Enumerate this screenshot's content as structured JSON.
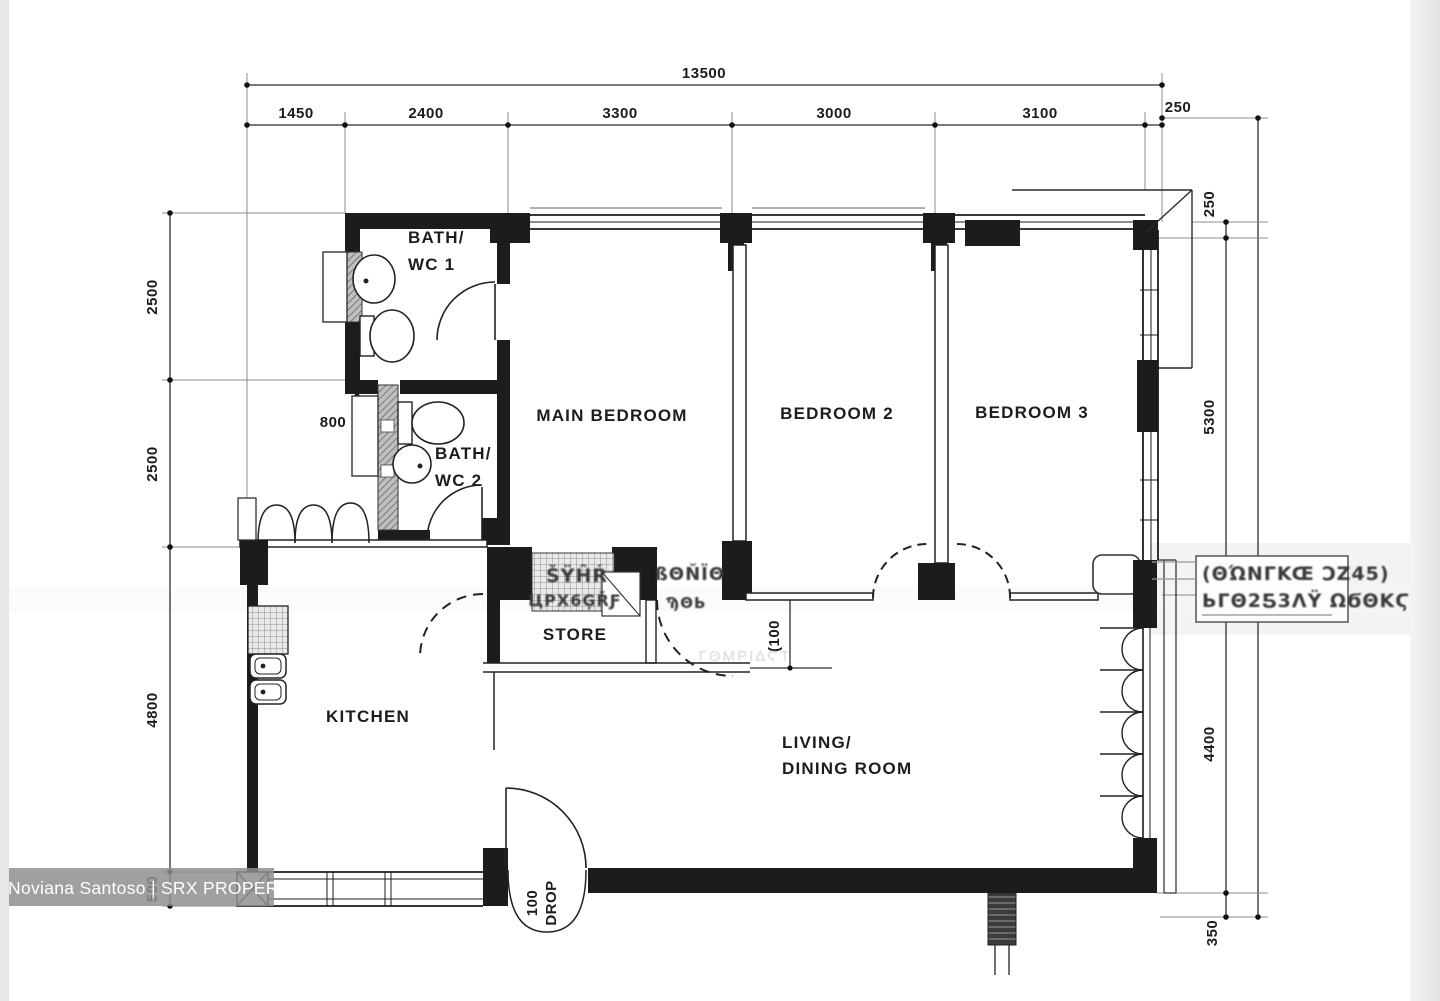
{
  "watermark": {
    "text": "Noviana Santoso | SRX PROPERTY"
  },
  "dimensions": {
    "top_total": "13500",
    "top_segments": [
      "1450",
      "2400",
      "3300",
      "3000",
      "3100",
      "250"
    ],
    "left": [
      "2500",
      "2500",
      "4800",
      "500"
    ],
    "left_inner": "800",
    "right_top": "250",
    "right": [
      "250",
      "5300",
      "4400",
      "350"
    ],
    "inner_offset": "(100",
    "entrance_line1": "100",
    "entrance_line2": "DROP"
  },
  "rooms": {
    "bath1_line1": "BATH/",
    "bath1_line2": "WC 1",
    "bath2_line1": "BATH/",
    "bath2_line2": "WC 2",
    "main_bedroom": "MAIN BEDROOM",
    "bedroom2": "BEDROOM 2",
    "bedroom3": "BEDROOM 3",
    "store": "STORE",
    "kitchen": "KITCHEN",
    "living_line1": "LIVING/",
    "living_line2": "DINING ROOM"
  },
  "artifacts": {
    "right_box_line1": "(ΘΏNΓKŒ ϽZ45)",
    "right_box_line2": "ЬΓΘ2Ƽ3ΛΫ ΩϬΘΚϚ",
    "store_garble_line1": "ŠΫĤŔ",
    "store_garble_line2": "ЦΡΧ6ĢŘƑ",
    "riser_garble_line1": "ßΘŇΪΘ",
    "riser_garble_line2": "ϠΘЬ",
    "ghost_text": "ΓΘΜΡΙΔϚΤ"
  },
  "colors": {
    "ink": "#1c1c1c",
    "dim_line": "#2e2e2e",
    "watermark_bg": "#8f8f8f",
    "watermark_text": "#ffffff",
    "paper": "#ffffff",
    "edge": "#e7e7e7"
  }
}
